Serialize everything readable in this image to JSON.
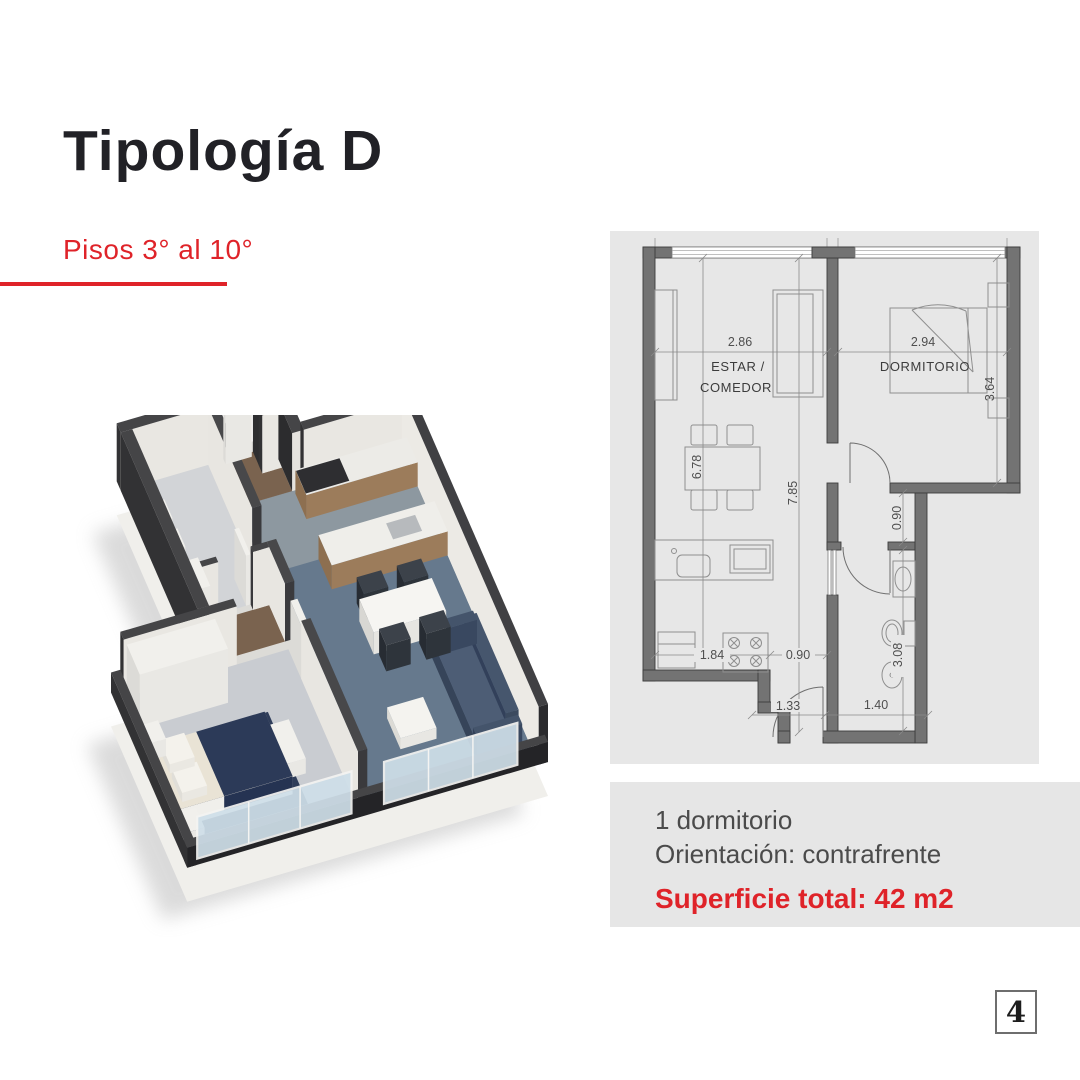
{
  "header": {
    "title": "Tipología D",
    "subtitle": "Pisos 3° al 10°"
  },
  "colors": {
    "accent": "#df2329",
    "panel": "#e7e7e7"
  },
  "floor_plan": {
    "rooms": {
      "living_line1": "ESTAR /",
      "living_line2": "COMEDOR",
      "bedroom": "DORMITORIO"
    },
    "dims": {
      "living_width": "2.86",
      "bedroom_width": "2.94",
      "bedroom_depth": "3.64",
      "living_depth": "6.78",
      "total_depth": "7.85",
      "hall_height": "0.90",
      "kitchen_left": "1.84",
      "kitchen_right": "0.90",
      "entry_width": "1.33",
      "bath_width": "1.40",
      "bath_depth": "3.08"
    }
  },
  "details": {
    "bedrooms": "1 dormitorio",
    "orientation": "Orientación: contrafrente",
    "surface": "Superficie total: 42 m2"
  },
  "page": {
    "number": "4"
  }
}
